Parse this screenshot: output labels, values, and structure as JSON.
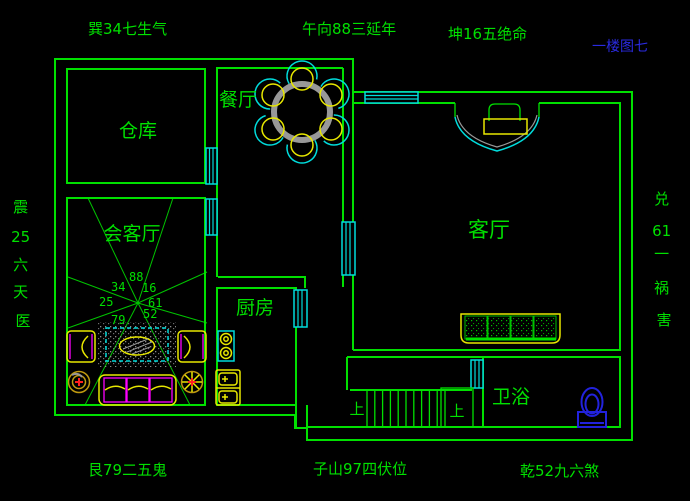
{
  "drawing_title": {
    "text": "一楼图七"
  },
  "compass_labels": {
    "top_left": "巽34七生气",
    "top_center": "午向88三延年",
    "top_right": "坤16五绝命",
    "bottom_left": "艮79二五鬼",
    "bottom_center": "子山97四伏位",
    "bottom_right": "乾52九六煞",
    "left_column": [
      "震",
      "25",
      "六",
      "天",
      "医"
    ],
    "right_column": [
      "兑",
      "61",
      "一",
      "祸",
      "害"
    ]
  },
  "room_labels": {
    "warehouse": "仓库",
    "reception": "会客厅",
    "dining": "餐厅",
    "kitchen": "厨房",
    "living": "客厅",
    "bathroom": "卫浴"
  },
  "stair_labels": {
    "left_up": "上",
    "right_up": "上"
  },
  "fengshui_numbers": [
    "88",
    "34",
    "16",
    "25",
    "61",
    "52",
    "79"
  ],
  "colors": {
    "background": "#000000",
    "wall_green": "#00e000",
    "window_cyan": "#00dcdc",
    "furniture_yellow": "#e8e800",
    "furniture_magenta": "#ff00ff",
    "table_gray": "#989898",
    "title_blue": "#2a2ae0",
    "toilet_blue": "#2222dd",
    "accent_red": "#ff2020"
  }
}
